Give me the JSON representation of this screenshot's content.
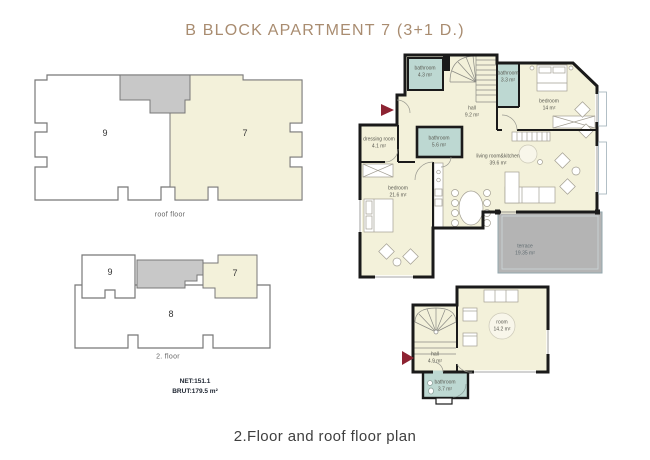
{
  "title": "B BLOCK APARTMENT 7 (3+1 D.)",
  "caption": "2.Floor and roof floor plan",
  "key_plans": {
    "roof_floor": {
      "label": "roof floor",
      "unit_left": "9",
      "unit_highlighted": "7"
    },
    "second_floor": {
      "label": "2. floor",
      "unit_left": "9",
      "unit_highlighted": "7",
      "unit_bottom": "8"
    }
  },
  "areas": {
    "net": "NET:151.1",
    "brut": "BRUT:179.5 m²"
  },
  "second_floor_plan": {
    "rooms": [
      {
        "name": "bathroom",
        "area": "4.3 m²"
      },
      {
        "name": "hall",
        "area": "9.2 m²"
      },
      {
        "name": "bathroom",
        "area": "3.3 m²"
      },
      {
        "name": "bedroom",
        "area": "14 m²"
      },
      {
        "name": "dressing room",
        "area": "4.1 m²"
      },
      {
        "name": "bathroom",
        "area": "5.6 m²"
      },
      {
        "name": "bedroom",
        "area": "21.6 m²"
      },
      {
        "name": "living room&kitchen",
        "area": "39.6 m²"
      },
      {
        "name": "terrace",
        "area": "19.35 m²"
      }
    ]
  },
  "roof_floor_plan": {
    "rooms": [
      {
        "name": "hall",
        "area": "4.9 m²"
      },
      {
        "name": "room",
        "area": "14.2 m²"
      },
      {
        "name": "bathroom",
        "area": "3.7 m²"
      }
    ]
  },
  "colors": {
    "title_text": "#a98c70",
    "floor_fill": "#f3f1da",
    "wet_fill": "#bdd8d2",
    "terrace_fill": "#b4b4b4",
    "keyplan_gray": "#c8c8c8",
    "wall": "#1a1a1a",
    "arrow": "#8d2332"
  }
}
